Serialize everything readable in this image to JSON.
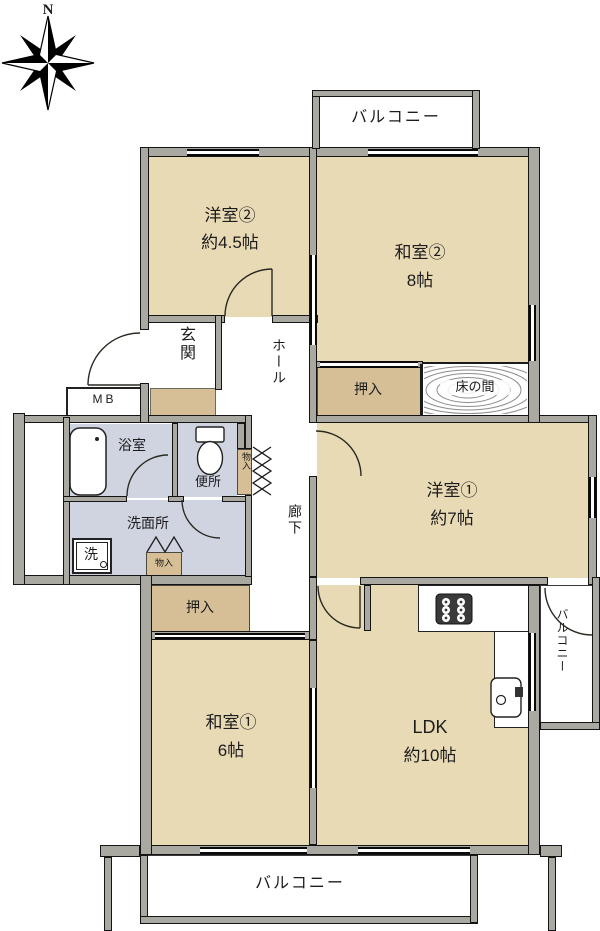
{
  "compass": {
    "north_label": "N"
  },
  "balconies": {
    "top": "バルコニー",
    "right": "バルコニー",
    "bottom": "バルコニー"
  },
  "rooms": {
    "yoshitsu2": {
      "name": "洋室②",
      "size": "約4.5帖"
    },
    "washitsu2": {
      "name": "和室②",
      "size": "8帖"
    },
    "yoshitsu1": {
      "name": "洋室①",
      "size": "約7帖"
    },
    "washitsu1": {
      "name": "和室①",
      "size": "6帖"
    },
    "ldk": {
      "name": "LDK",
      "size": "約10帖"
    },
    "genkan": "玄関",
    "hall": "ホール",
    "corridor": "廊下",
    "bathroom": "浴室",
    "toilet": "便所",
    "washroom": "洗面所",
    "laundry": "洗",
    "tokonoma": "床の間",
    "oshiire_upper": "押入",
    "oshiire_lower": "押入",
    "monoire_1": "物入",
    "monoire_2": "物入",
    "meter_box": "MB"
  },
  "colors": {
    "room_tan": "#e9dab6",
    "closet_tan": "#d6bf97",
    "wet_blue": "#cfd4e0",
    "wall_gray": "#a9a9a1",
    "line_black": "#141414"
  }
}
